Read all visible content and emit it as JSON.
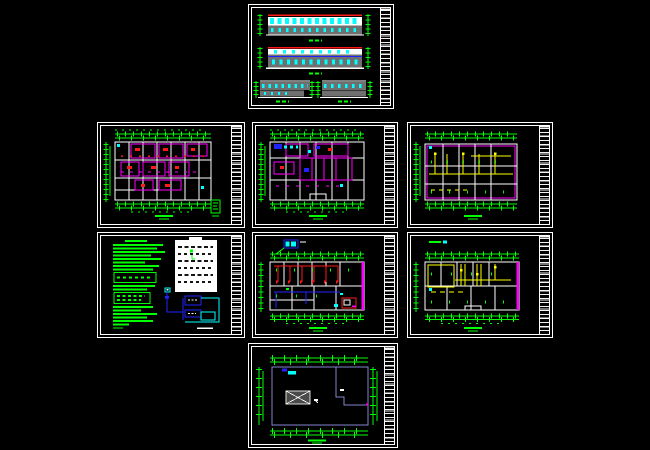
{
  "app": {
    "name": "cad-drawing-set-overview",
    "background": "#000000",
    "sheet_count": 8
  },
  "palette": {
    "bg": "#000000",
    "white": "#ffffff",
    "green": "#00ff00",
    "cyan": "#00ffff",
    "red": "#ff1a1a",
    "magenta": "#ff00ff",
    "yellow": "#ffff00",
    "blue": "#2222ff",
    "gray": "#6f6f6f",
    "dark": "#4a4a4a",
    "roof": "#8585cc"
  },
  "sheets": [
    {
      "id": "elevations",
      "kind": "building elevations and sections"
    },
    {
      "id": "floor-plan-1",
      "kind": "dense floor plan, magenta rooms"
    },
    {
      "id": "floor-plan-2",
      "kind": "floor plan, magenta grid with blue accents"
    },
    {
      "id": "floor-plan-3",
      "kind": "floor plan with yellow wiring"
    },
    {
      "id": "notes-legend",
      "kind": "green notes, white legend table, blue riser diagram"
    },
    {
      "id": "power-plan",
      "kind": "plan with red feeders and blue main"
    },
    {
      "id": "lighting-plan",
      "kind": "plan with yellow circuits"
    },
    {
      "id": "roof-plan",
      "kind": "roof plan with hatch box"
    }
  ]
}
